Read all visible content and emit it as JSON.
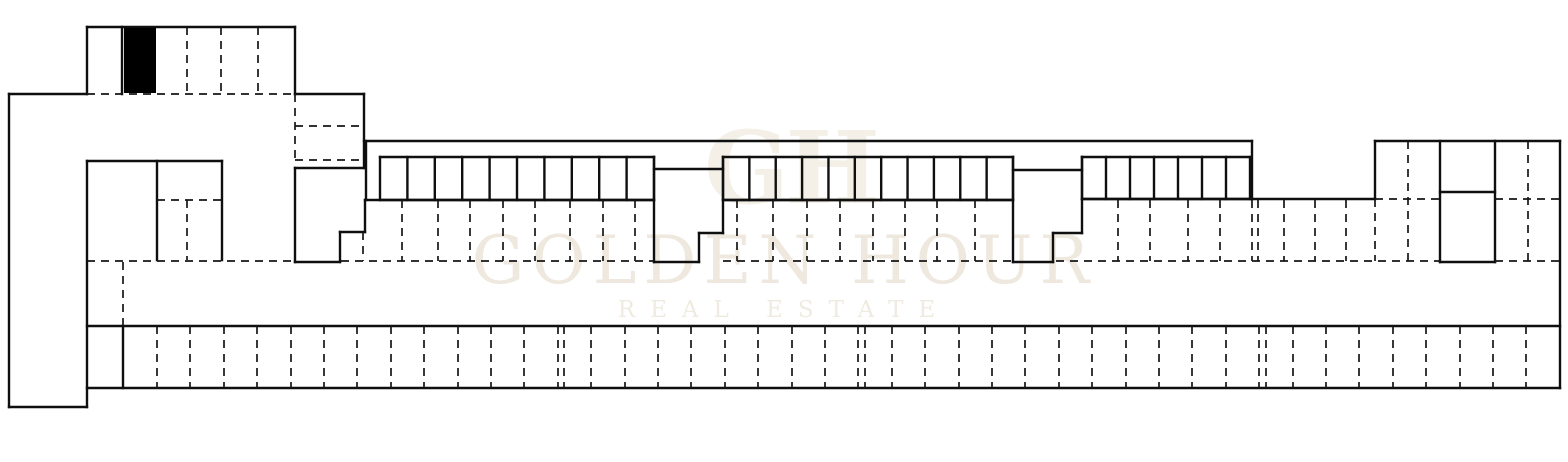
{
  "watermark": {
    "monogram": "GH",
    "line1": "GOLDEN HOUR",
    "line2": "REAL ESTATE",
    "color": "#eee8de"
  },
  "plan": {
    "width": 1568,
    "height": 462,
    "background": "#ffffff",
    "wall_color": "#0f0f0f",
    "partition_color": "#161616",
    "black_column": {
      "x": 124,
      "y": 28,
      "w": 32,
      "h": 65
    },
    "solid_lines": [
      [
        9,
        94,
        87,
        94
      ],
      [
        9,
        94,
        9,
        407
      ],
      [
        9,
        407,
        87,
        407
      ],
      [
        87,
        161,
        87,
        407
      ],
      [
        87,
        27,
        295,
        27
      ],
      [
        87,
        27,
        87,
        94
      ],
      [
        295,
        27,
        295,
        94
      ],
      [
        122,
        27,
        122,
        94
      ],
      [
        295,
        94,
        364,
        94
      ],
      [
        364,
        94,
        364,
        168
      ],
      [
        295,
        168,
        364,
        168
      ],
      [
        295,
        168,
        295,
        262
      ],
      [
        295,
        262,
        340,
        262
      ],
      [
        340,
        232,
        340,
        262
      ],
      [
        340,
        232,
        365,
        232
      ],
      [
        365,
        200,
        365,
        232
      ],
      [
        366,
        141,
        366,
        200
      ],
      [
        365,
        200,
        654,
        200
      ],
      [
        364,
        141,
        1252,
        141
      ],
      [
        87,
        161,
        222,
        161
      ],
      [
        157,
        161,
        157,
        260
      ],
      [
        222,
        161,
        222,
        260
      ],
      [
        654,
        157,
        654,
        262
      ],
      [
        654,
        169,
        723,
        169
      ],
      [
        654,
        262,
        699,
        262
      ],
      [
        699,
        233,
        699,
        262
      ],
      [
        699,
        233,
        723,
        233
      ],
      [
        723,
        157,
        723,
        233
      ],
      [
        723,
        200,
        1013,
        200
      ],
      [
        1013,
        157,
        1013,
        262
      ],
      [
        1013,
        170,
        1082,
        170
      ],
      [
        1013,
        262,
        1053,
        262
      ],
      [
        1053,
        233,
        1053,
        262
      ],
      [
        1053,
        233,
        1082,
        233
      ],
      [
        1082,
        157,
        1082,
        233
      ],
      [
        1082,
        199,
        1252,
        199
      ],
      [
        1252,
        141,
        1252,
        199
      ],
      [
        1252,
        199,
        1375,
        199
      ],
      [
        1375,
        141,
        1560,
        141
      ],
      [
        1375,
        141,
        1375,
        199
      ],
      [
        1440,
        141,
        1440,
        262
      ],
      [
        1495,
        141,
        1495,
        262
      ],
      [
        1440,
        192,
        1495,
        192
      ],
      [
        1440,
        262,
        1495,
        262
      ],
      [
        1560,
        141,
        1560,
        388
      ],
      [
        87,
        326,
        1560,
        326
      ],
      [
        87,
        388,
        1560,
        388
      ],
      [
        123,
        326,
        123,
        388
      ]
    ],
    "dashed_lines": [
      [
        87,
        94,
        295,
        94
      ],
      [
        187,
        27,
        187,
        94
      ],
      [
        221,
        27,
        221,
        94
      ],
      [
        258,
        27,
        258,
        94
      ],
      [
        295,
        94,
        295,
        160
      ],
      [
        295,
        126,
        364,
        126
      ],
      [
        295,
        160,
        364,
        160
      ],
      [
        157,
        200,
        222,
        200
      ],
      [
        187,
        200,
        187,
        260
      ],
      [
        87,
        261,
        295,
        261
      ],
      [
        341,
        261,
        654,
        261
      ],
      [
        723,
        261,
        1013,
        261
      ],
      [
        1056,
        261,
        1440,
        261
      ],
      [
        1495,
        261,
        1560,
        261
      ],
      [
        123,
        262,
        123,
        326
      ],
      [
        1408,
        141,
        1408,
        261
      ],
      [
        1528,
        141,
        1528,
        261
      ],
      [
        1375,
        199,
        1440,
        199
      ],
      [
        1495,
        199,
        1560,
        199
      ],
      [
        1375,
        199,
        1375,
        261
      ],
      [
        363,
        232,
        363,
        261
      ]
    ],
    "storage_runs": [
      {
        "x1": 380,
        "x2": 654,
        "y1": 157,
        "y2": 200,
        "cells": 10
      },
      {
        "x1": 723,
        "x2": 1013,
        "y1": 157,
        "y2": 200,
        "cells": 11
      },
      {
        "x1": 1082,
        "x2": 1250,
        "y1": 157,
        "y2": 199,
        "cells": 7
      }
    ],
    "parking_mid": {
      "y1": 200,
      "y2": 261,
      "xs": [
        402,
        438,
        470,
        503,
        535,
        570,
        603,
        635,
        737,
        773,
        807,
        840,
        873,
        905,
        937,
        975,
        1118,
        1150,
        1188,
        1220,
        1252,
        1258,
        1284,
        1315,
        1346
      ]
    },
    "parking_band": {
      "y1": 326,
      "y2": 388,
      "xs": [
        157,
        190,
        224,
        257,
        291,
        324,
        357,
        391,
        424,
        458,
        491,
        524,
        558,
        564,
        591,
        625,
        658,
        691,
        725,
        758,
        792,
        825,
        858,
        865,
        892,
        925,
        959,
        992,
        1025,
        1059,
        1092,
        1126,
        1159,
        1192,
        1226,
        1259,
        1266,
        1293,
        1326,
        1359,
        1393,
        1426,
        1460,
        1493,
        1526
      ]
    }
  }
}
